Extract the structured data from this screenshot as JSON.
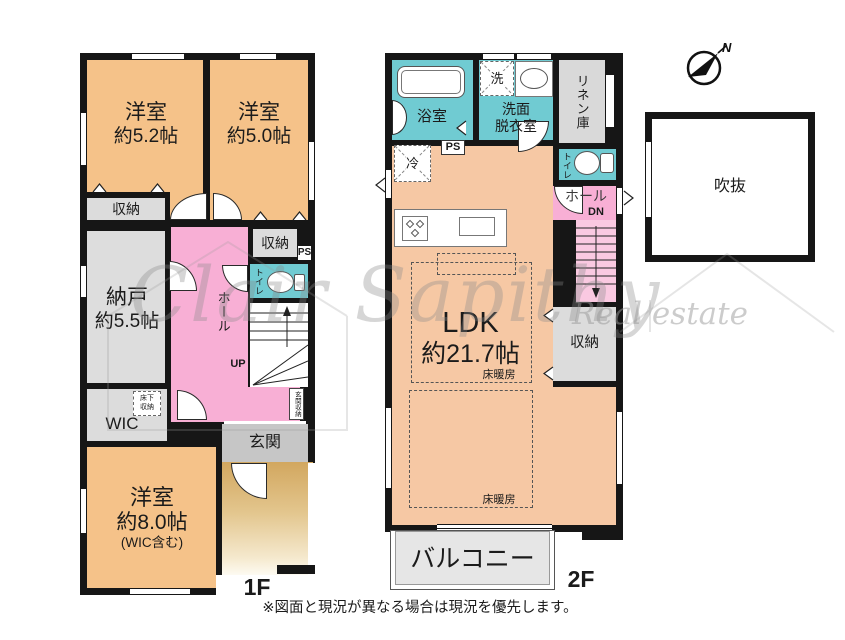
{
  "colors": {
    "wall": "#161616",
    "bedroom_orange": "#F5C289",
    "ldk_orange": "#F6C8A4",
    "hall_pink": "#F8AFD5",
    "stair_pink": "#FAC9E1",
    "wet_cyan": "#70CBD2",
    "closet_gray": "#DCDCDC",
    "genkan_gray": "#C6C6C6",
    "balcony_gray": "#E6E6E6",
    "porch_tan": "#D7AF68"
  },
  "compass": {
    "north": "N"
  },
  "watermark": {
    "brand": "Clair Sapithy",
    "sub": "Real estate"
  },
  "disclaimer": "※図面と現況が異なる場合は現況を優先します。",
  "floor1": {
    "floor_label": "1F",
    "room52_name": "洋室",
    "room52_size": "約5.2帖",
    "room50_name": "洋室",
    "room50_size": "約5.0帖",
    "closet_top": "収納",
    "nando_name": "納戸",
    "nando_size": "約5.5帖",
    "closet_mid": "収納",
    "ps": "PS",
    "toilet": "トイレ",
    "hall": "ホール",
    "up": "UP",
    "stair_storage": "玄関収納",
    "underfloor_storage": "床下収納",
    "wic": "WIC",
    "room80_name": "洋室",
    "room80_size": "約8.0帖",
    "room80_note": "(WIC含む)",
    "genkan": "玄関"
  },
  "floor2": {
    "floor_label": "2F",
    "bath": "浴室",
    "washer": "洗",
    "washroom_line1": "洗面",
    "washroom_line2": "脱衣室",
    "linen": "リネン庫",
    "fridge": "冷",
    "ps": "PS",
    "toilet": "トイレ",
    "hall": "ホール",
    "dn": "DN",
    "ldk_name": "LDK",
    "ldk_size": "約21.7帖",
    "floor_heating_1": "床暖房",
    "floor_heating_2": "床暖房",
    "closet": "収納",
    "balcony": "バルコニー",
    "void": "吹抜"
  }
}
